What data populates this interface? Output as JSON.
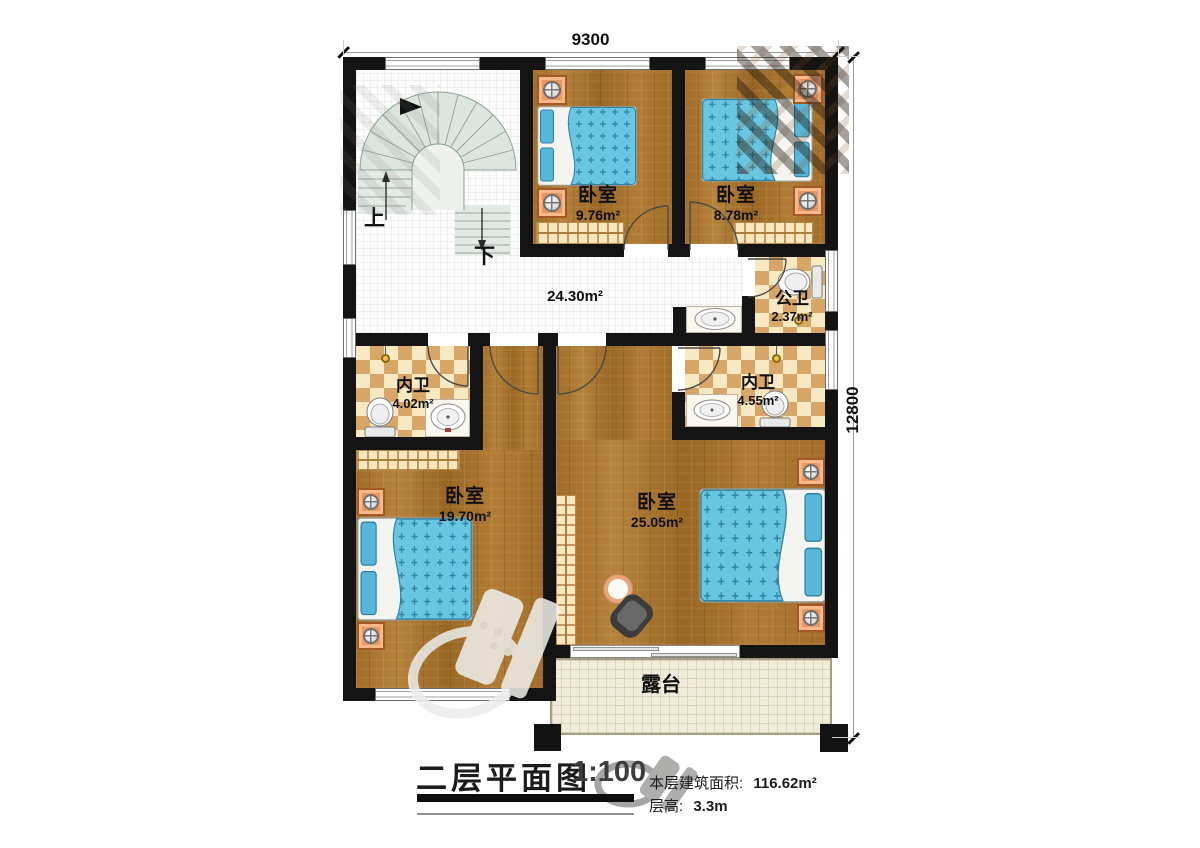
{
  "plan": {
    "dimension_width": "9300",
    "dimension_height": "12800",
    "stairs_up": "上",
    "stairs_down": "下"
  },
  "rooms": {
    "bedroom_top_left": {
      "name": "卧室",
      "area": "9.76m²"
    },
    "bedroom_top_right": {
      "name": "卧室",
      "area": "8.78m²"
    },
    "hallway": {
      "area": "24.30m²"
    },
    "public_bath": {
      "name": "公卫",
      "area": "2.37m²"
    },
    "ensuite_left": {
      "name": "内卫",
      "area": "4.02m²"
    },
    "ensuite_right": {
      "name": "内卫",
      "area": "4.55m²"
    },
    "bedroom_bottom_left": {
      "name": "卧室",
      "area": "19.70m²"
    },
    "bedroom_bottom_right": {
      "name": "卧室",
      "area": "25.05m²"
    },
    "terrace": {
      "name": "露台"
    }
  },
  "title_block": {
    "title": "二层平面图",
    "scale": "1:100",
    "floor_area_label": "本层建筑面积:",
    "floor_area_value": "116.62m²",
    "floor_height_label": "层高:",
    "floor_height_value": "3.3m"
  },
  "colors": {
    "wall": "#141414",
    "wood_floor": "#a8762f",
    "bath_checker": "#d8a667",
    "bed_quilt": "#69c6e0",
    "bed_pillow": "#58b7d8",
    "nightstand": "#ea965e",
    "stairs_fill": "#dde5df",
    "terrace_floor": "#f1ecda",
    "hall_tile": "#fdfdfd"
  }
}
